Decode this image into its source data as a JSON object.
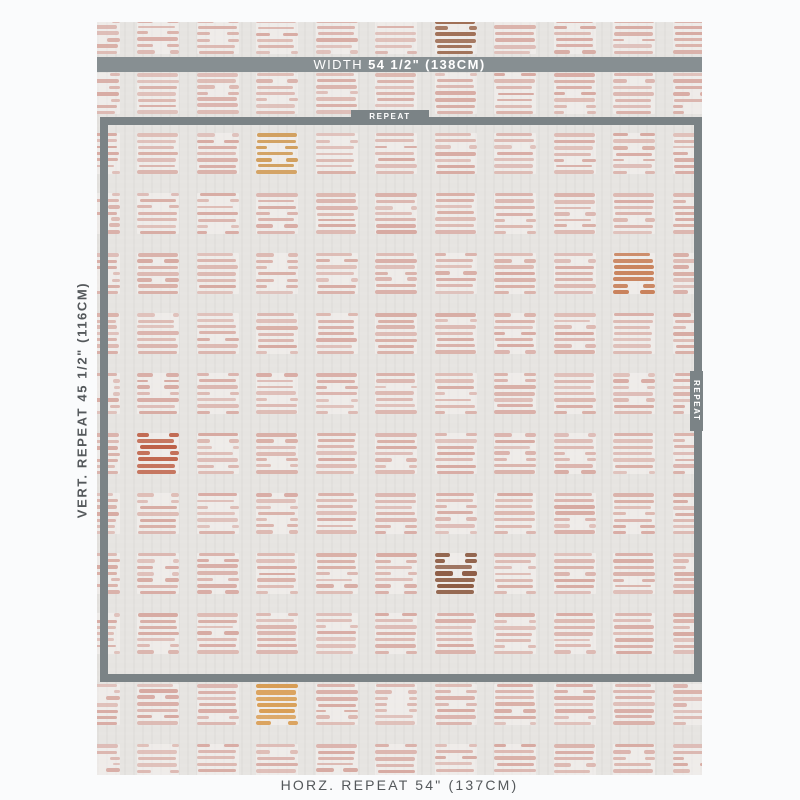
{
  "labels": {
    "width_prefix": "WIDTH",
    "width_value": "54 1/2\" (138CM)",
    "vert_repeat": "VERT. REPEAT 45 1/2\" (116CM)",
    "horz_repeat": "HORZ. REPEAT 54\" (137CM)",
    "repeat_top": "REPEAT",
    "repeat_right": "REPEAT"
  },
  "colors": {
    "page_bg": "#fafbfc",
    "fabric_bg": "#e6e4e1",
    "pattern_pink": "#d7aaa2",
    "bar_gray": "#878f92",
    "frame_gray": "#7b8386",
    "label_text": "#54585b",
    "accent_top_brown": "#9c6a50",
    "accent_gold": "#d09c58",
    "accent_terracotta": "#c8815a",
    "accent_rust": "#bd5f45",
    "accent_brown": "#8d5c44",
    "accent_gold_bottom": "#d89c52"
  },
  "pattern": {
    "cols": 11,
    "rows": 13,
    "col_start": -19.5,
    "col_pitch": 59.5,
    "row_start": -9,
    "row_pitch": 60,
    "row_shift_after": 10,
    "row_shift_px": 11,
    "block_w": 42,
    "block_h": 41,
    "lines_per_block": 7,
    "accents": [
      {
        "col": 6,
        "row": 0,
        "color_key": "accent_top_brown"
      },
      {
        "col": 3,
        "row": 2,
        "color_key": "accent_gold"
      },
      {
        "col": 9,
        "row": 4,
        "color_key": "accent_terracotta"
      },
      {
        "col": 1,
        "row": 7,
        "color_key": "accent_rust"
      },
      {
        "col": 6,
        "row": 9,
        "color_key": "accent_brown"
      },
      {
        "col": 3,
        "row": 11,
        "color_key": "accent_gold_bottom"
      }
    ]
  }
}
